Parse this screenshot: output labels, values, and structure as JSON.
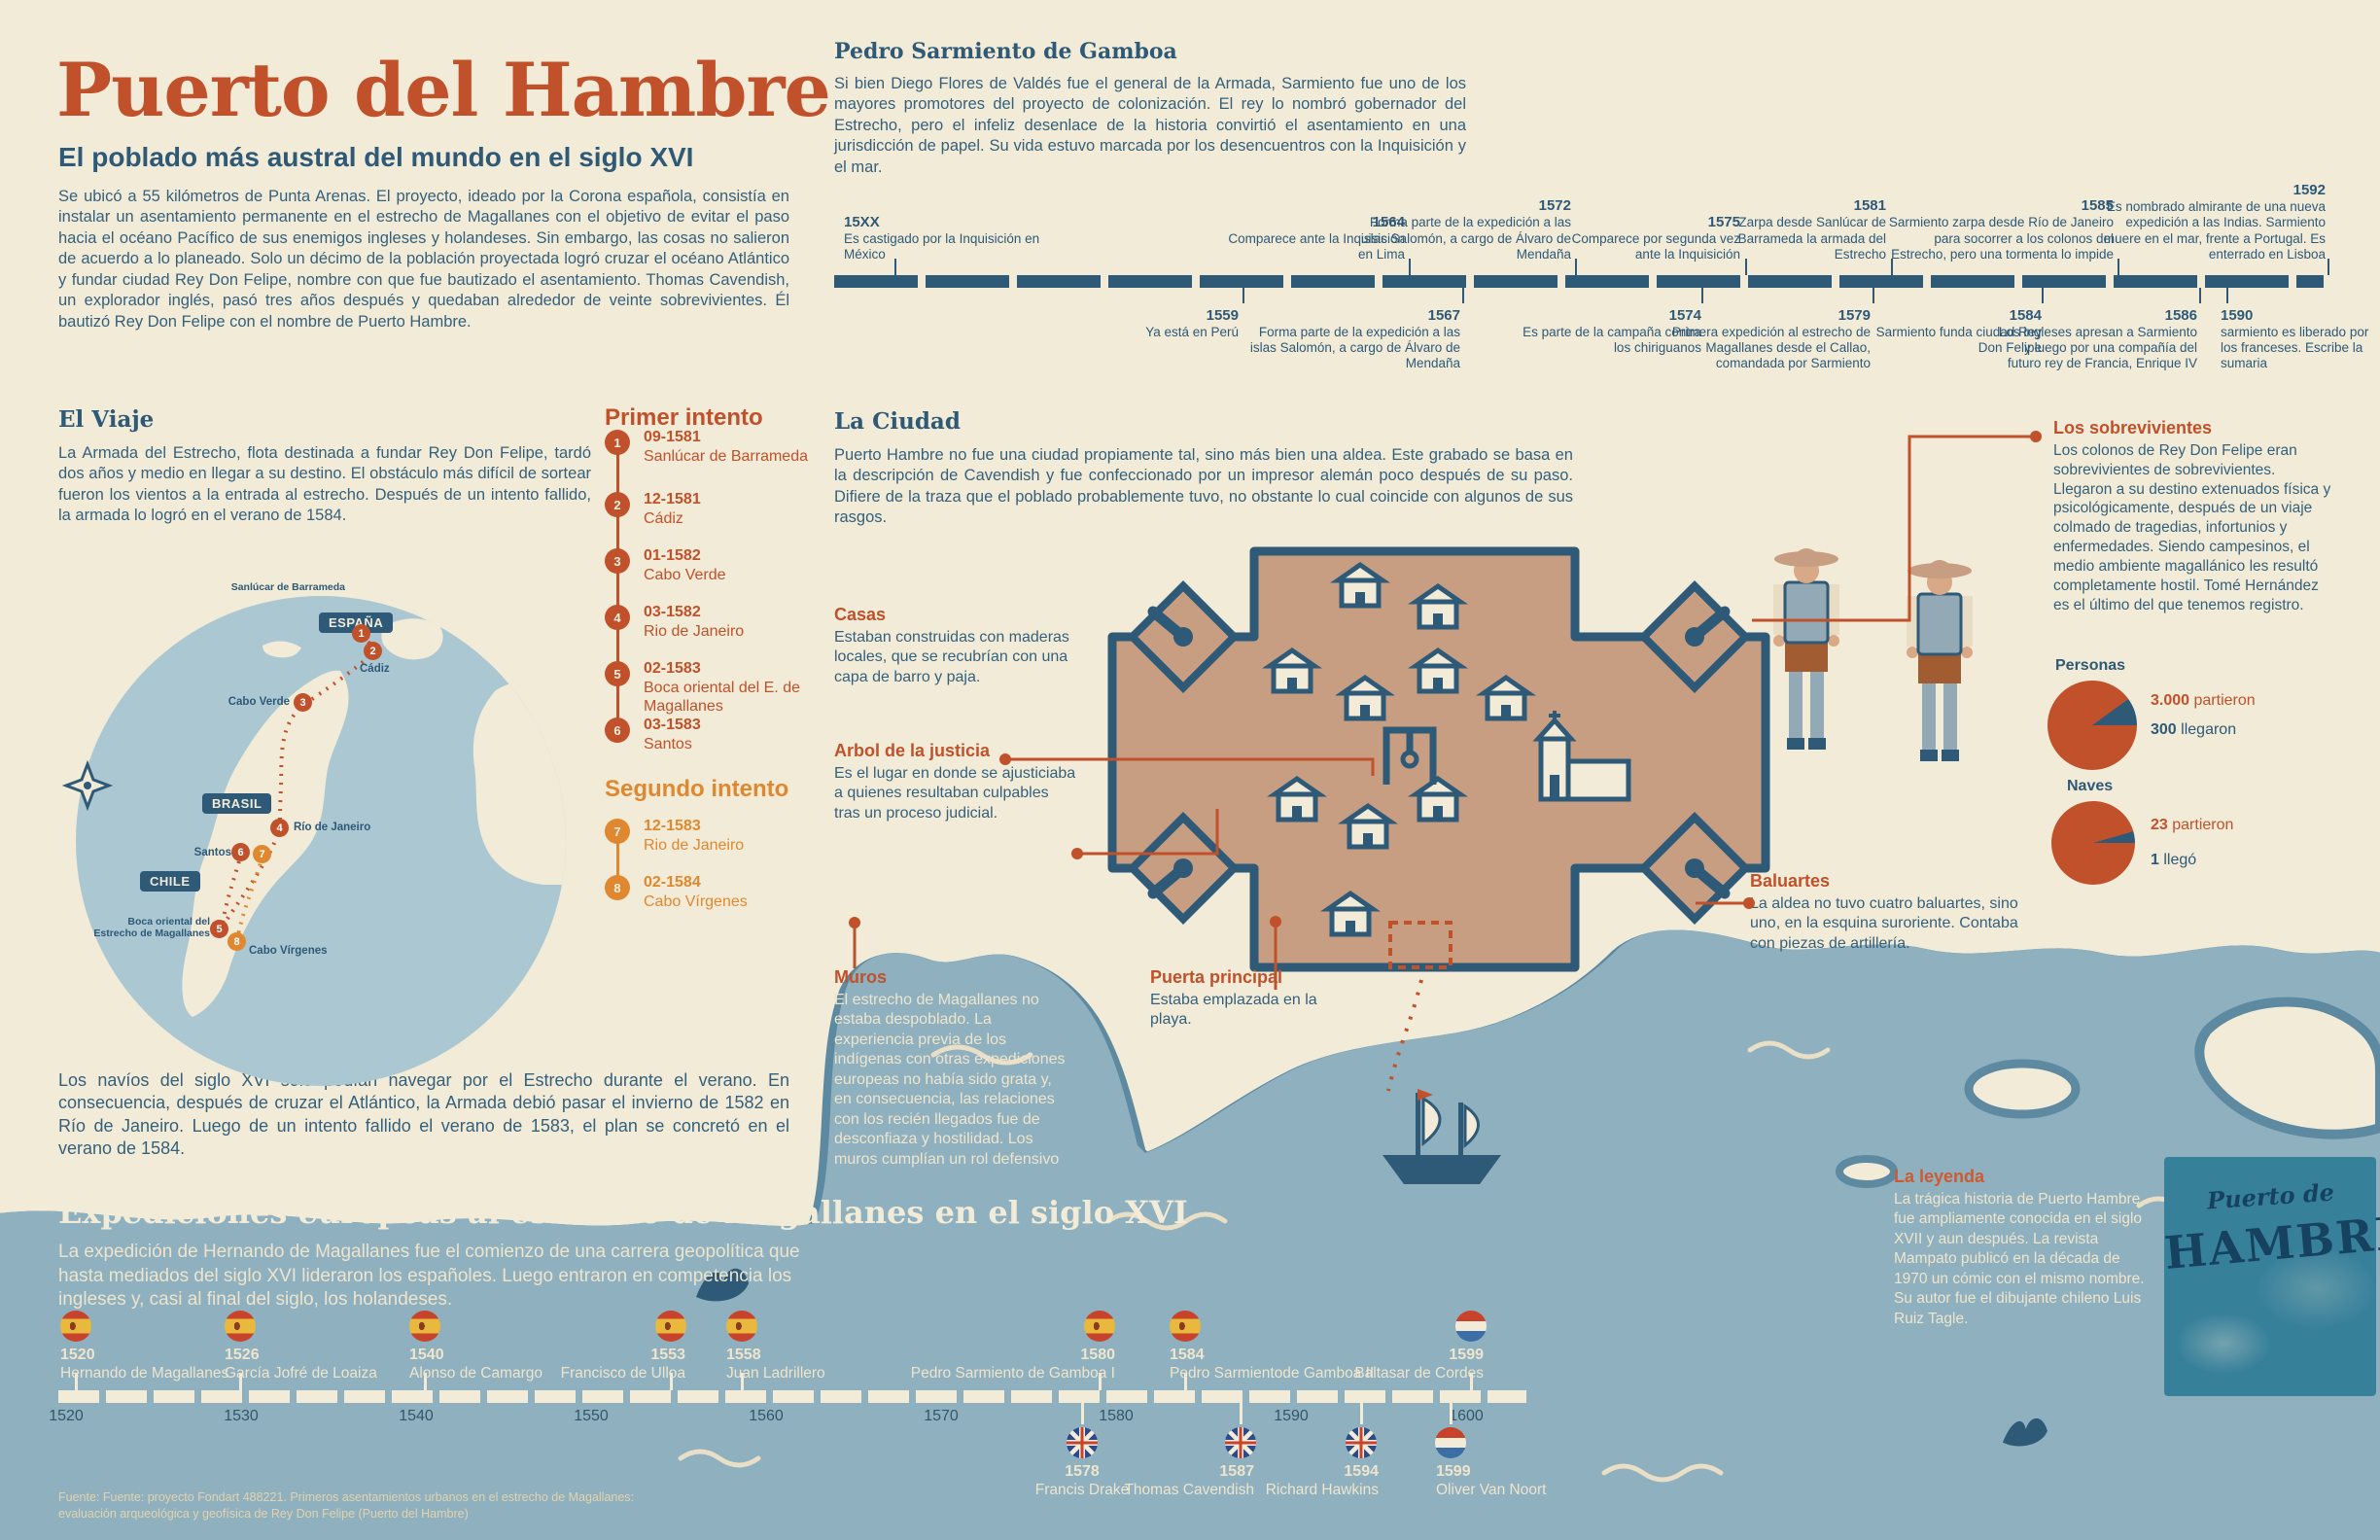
{
  "colors": {
    "accent_red": "#c0512b",
    "accent_orange": "#e0882f",
    "ink_blue": "#2e5977",
    "cream": "#f2ebd8",
    "water": "#8fb0bf",
    "fort_tan": "#c79e82"
  },
  "header": {
    "title": "Puerto del Hambre",
    "subtitle": "El poblado más austral del mundo en el siglo XVI",
    "intro": "Se ubicó a 55 kilómetros de Punta Arenas. El proyecto, ideado por la Corona española, consistía en instalar un asentamiento permanente en el estrecho de Magallanes con el objetivo de evitar el paso hacia el océano Pacífico de sus enemigos ingleses y holandeses. Sin embargo, las cosas no salieron de acuerdo a lo planeado. Solo un décimo de la población proyectada logró cruzar el océano Atlántico y fundar ciudad Rey Don Felipe, nombre con que fue bautizado el asentamiento. Thomas Cavendish, un explorador inglés, pasó tres años después y quedaban alrededor de veinte sobrevivientes. Él bautizó Rey Don Felipe con el nombre de Puerto Hambre."
  },
  "sarmiento": {
    "heading": "Pedro Sarmiento de Gamboa",
    "body": "Si bien Diego Flores de Valdés fue el general de la Armada, Sarmiento fue uno de los mayores promotores del proyecto de colonización. El rey lo nombró gobernador del Estrecho, pero el infeliz desenlace de la historia convirtió el asentamiento en una jurisdicción de papel. Su vida estuvo marcada por los desencuentros con la Inquisición y el mar.",
    "events_top": [
      {
        "y": "15XX",
        "t": "Es castigado por la Inquisición en México"
      },
      {
        "y": "1564",
        "t": "Comparece ante la Inquisición en Lima"
      },
      {
        "y": "1572",
        "t": "Forma parte de la expedición a las islas Salomón, a cargo de Álvaro de Mendaña"
      },
      {
        "y": "1575",
        "t": "Comparece por segunda vez ante la Inquisición"
      },
      {
        "y": "1581",
        "t": "Zarpa desde Sanlúcar de Barrameda la armada del Estrecho"
      },
      {
        "y": "1585",
        "t": "Sarmiento zarpa desde Río de Janeiro para socorrer a los colonos del Estrecho, pero una tormenta lo impide"
      },
      {
        "y": "1592",
        "t": "Es nombrado almirante de una nueva expedición a las Indias. Sarmiento muere en el mar, frente a Portugal. Es enterrado en Lisboa"
      }
    ],
    "events_bottom": [
      {
        "y": "1559",
        "t": "Ya está en Perú"
      },
      {
        "y": "1567",
        "t": "Forma parte de la expedición a las islas Salomón, a cargo de Álvaro de Mendaña"
      },
      {
        "y": "1574",
        "t": "Es parte de la campaña contra los chiriguanos"
      },
      {
        "y": "1579",
        "t": "Primera expedición al estrecho de Magallanes desde el Callao, comandada por Sarmiento"
      },
      {
        "y": "1584",
        "t": "Sarmiento funda ciudad Rey Don Felipe"
      },
      {
        "y": "1586",
        "t": "Los ingleses apresan a Sarmiento y luego por una compañía del futuro rey de Francia, Enrique IV"
      },
      {
        "y": "1590",
        "t": "sarmiento es liberado por los franceses. Escribe la sumaria"
      }
    ]
  },
  "viaje": {
    "heading": "El Viaje",
    "body": "La Armada del Estrecho, flota destinada a fundar Rey Don Felipe, tardó dos años y medio en llegar a su destino. El obstáculo más difícil de sortear fueron los vientos a la entrada al estrecho. Después de un intento fallido, la armada lo logró en el verano de 1584.",
    "note": "Los navíos del siglo XVI solo podían navegar por el Estrecho durante el verano. En consecuencia, después de cruzar el Atlántico, la Armada debió pasar el invierno de 1582 en Río de Janeiro. Luego de un intento fallido el verano de 1583, el plan se concretó en el verano de 1584."
  },
  "map": {
    "badges": {
      "espana": "ESPAÑA",
      "brasil": "BRASIL",
      "chile": "CHILE"
    },
    "labels": {
      "sanlucar": "Sanlúcar de Barrameda",
      "cadiz": "Cádiz",
      "cabo_verde": "Cabo Verde",
      "rio": "Río de Janeiro",
      "santos": "Santos",
      "boca": "Boca oriental del Estrecho de Magallanes",
      "cabo_virgenes": "Cabo Vírgenes"
    },
    "points": [
      {
        "n": "1"
      },
      {
        "n": "2"
      },
      {
        "n": "3"
      },
      {
        "n": "4"
      },
      {
        "n": "5"
      },
      {
        "n": "6"
      },
      {
        "n": "7"
      },
      {
        "n": "8"
      }
    ]
  },
  "intentos": {
    "primer": {
      "heading": "Primer intento",
      "items": [
        {
          "n": "1",
          "date": "09-1581",
          "place": "Sanlúcar de Barrameda"
        },
        {
          "n": "2",
          "date": "12-1581",
          "place": "Cádiz"
        },
        {
          "n": "3",
          "date": "01-1582",
          "place": "Cabo Verde"
        },
        {
          "n": "4",
          "date": "03-1582",
          "place": "Rio de Janeiro"
        },
        {
          "n": "5",
          "date": "02-1583",
          "place": "Boca oriental del E. de Magallanes"
        },
        {
          "n": "6",
          "date": "03-1583",
          "place": "Santos"
        }
      ]
    },
    "segundo": {
      "heading": "Segundo intento",
      "items": [
        {
          "n": "7",
          "date": "12-1583",
          "place": "Rio de Janeiro"
        },
        {
          "n": "8",
          "date": "02-1584",
          "place": "Cabo Vírgenes"
        }
      ]
    }
  },
  "ciudad": {
    "heading": "La Ciudad",
    "body": "Puerto Hambre no fue una ciudad propiamente tal, sino más bien una aldea. Este grabado se basa en la descripción de Cavendish y fue confeccionado por un impresor alemán poco después de su paso. Difiere de la traza que el poblado probablemente tuvo, no obstante lo cual coincide con algunos de sus rasgos."
  },
  "annotations": {
    "casas": {
      "heading": "Casas",
      "body": "Estaban construidas con maderas locales, que se recubrían con una capa de barro y paja."
    },
    "arbol": {
      "heading": "Arbol de la justicia",
      "body": "Es el lugar en donde se ajusticiaba a quienes resultaban culpables tras un proceso judicial."
    },
    "muros": {
      "heading": "Muros",
      "body": "El estrecho de Magallanes no estaba despoblado. La experiencia previa de los indígenas con otras expediciones europeas no había sido grata y, en consecuencia, las relaciones con los recién llegados fue de desconfiaza y hostilidad. Los muros cumplían un rol defensivo"
    },
    "puerta": {
      "heading": "Puerta principal",
      "body": "Estaba emplazada en la playa."
    },
    "baluartes": {
      "heading": "Baluartes",
      "body": "La aldea no tuvo cuatro baluartes, sino uno, en la esquina suroriente. Contaba con piezas de artillería."
    },
    "sobrevivientes": {
      "heading": "Los sobrevivientes",
      "body": "Los colonos de Rey Don Felipe eran sobrevivientes de sobrevivientes. Llegaron a su destino extenuados física y psicológicamente, después de un viaje colmado de tragedias, infortunios y enfermedades. Siendo campesinos, el medio ambiente magallánico les resultó completamente hostil. Tomé Hernández es el último del que tenemos registro."
    }
  },
  "stats": {
    "personas": {
      "heading": "Personas",
      "departed": "3.000",
      "departed_label": "partieron",
      "arrived": "300",
      "arrived_label": "llegaron",
      "departed_value": 3000,
      "arrived_value": 300
    },
    "naves": {
      "heading": "Naves",
      "departed": "23",
      "departed_label": "partieron",
      "arrived": "1",
      "arrived_label": "llegó",
      "departed_value": 23,
      "arrived_value": 1
    }
  },
  "expediciones": {
    "heading": "Expediciones europeas al estrecho de Magallanes en el siglo XVI",
    "body": "La expedición de Hernando de Magallanes fue el comienzo de una carrera geopolítica que hasta mediados del siglo XVI lideraron los españoles. Luego entraron en competencia los ingleses y, casi al final del siglo, los holandeses.",
    "axis": [
      "1520",
      "1530",
      "1540",
      "1550",
      "1560",
      "1570",
      "1580",
      "1590",
      "1600"
    ],
    "spanish": [
      {
        "year": "1520",
        "name": "Hernando de Magallanes",
        "flag": "spain-flag"
      },
      {
        "year": "1526",
        "name": "García Jofré de Loaiza",
        "flag": "spain-flag"
      },
      {
        "year": "1540",
        "name": "Alonso de Camargo",
        "flag": "spain-flag"
      },
      {
        "year": "1553",
        "name": "Francisco de Ulloa",
        "flag": "spain-flag"
      },
      {
        "year": "1558",
        "name": "Juan Ladrillero",
        "flag": "spain-flag"
      },
      {
        "year": "1580",
        "name": "Pedro Sarmiento de Gamboa I",
        "flag": "spain-flag"
      },
      {
        "year": "1584",
        "name": "Pedro Sarmientode Gamboa II",
        "flag": "spain-flag"
      },
      {
        "year": "1599",
        "name": "Baltasar de Cordes",
        "flag": "netherlands-flag"
      }
    ],
    "rivals": [
      {
        "year": "1578",
        "name": "Francis Drake",
        "flag": "uk-flag"
      },
      {
        "year": "1587",
        "name": "Thomas Cavendish",
        "flag": "uk-flag"
      },
      {
        "year": "1594",
        "name": "Richard Hawkins",
        "flag": "uk-flag"
      },
      {
        "year": "1599",
        "name": "Oliver Van Noort",
        "flag": "netherlands-flag"
      }
    ]
  },
  "leyenda": {
    "heading": "La leyenda",
    "body": "La trágica historia de Puerto Hambre fue ampliamente conocida en el siglo XVII y aun después. La revista Mampato publicó en la década de 1970 un cómic con el mismo nombre. Su autor fue el dibujante chileno Luis Ruiz Tagle."
  },
  "book": {
    "top_text": "Puerto de",
    "main_text": "HAMBRE"
  },
  "footer": {
    "line1": "Fuente:  Fuente: proyecto Fondart 488221. Primeros asentamientos urbanos en el estrecho de Magallanes:",
    "line2": "evaluación arqueológica y geofísica de Rey Don Felipe (Puerto del Hambre)"
  }
}
